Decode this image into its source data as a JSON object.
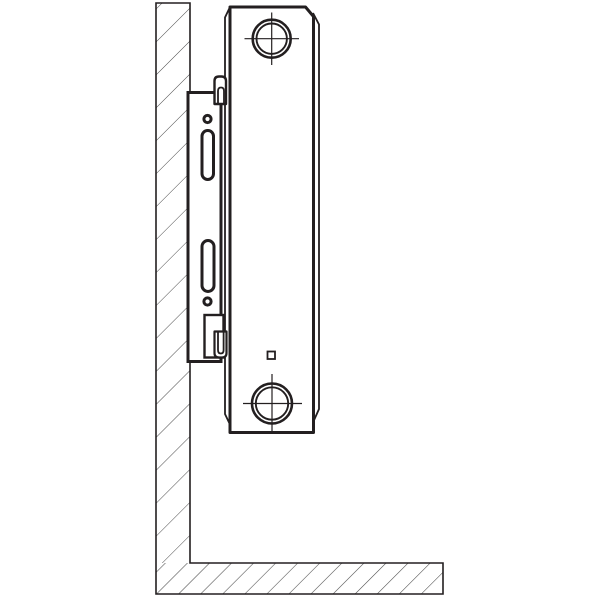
{
  "meta": {
    "kind": "technical-diagram",
    "subject": "radiator-wall-mounting-bracket-side-section"
  },
  "colors": {
    "line": "#231f20",
    "hatch": "#4a4a4a",
    "background": "#ffffff",
    "fill": "#ffffff"
  },
  "canvas": {
    "width": 600,
    "height": 600
  },
  "diagram": {
    "shapes": [
      {
        "name": "wall-section-hatch",
        "type": "rect",
        "attrs": {
          "x": 156,
          "y": 3,
          "width": 34,
          "height": 560,
          "fill": "url(#hatch-wall)",
          "stroke": "none"
        }
      },
      {
        "name": "floor-section-hatch",
        "type": "rect",
        "attrs": {
          "x": 156,
          "y": 563,
          "width": 287,
          "height": 31,
          "fill": "url(#hatch-floor)",
          "stroke": "none"
        }
      },
      {
        "name": "wall-floor-outline",
        "type": "path",
        "attrs": {
          "d": "M 156,3 L 190,3 L 190,563 L 443,563 L 443,594 L 156,594 Z",
          "fill": "none",
          "stroke": "#231f20",
          "stroke-width": 1.6
        }
      },
      {
        "name": "radiator-back-edge-left",
        "type": "path",
        "attrs": {
          "d": "M 229.5,8 L 225,17.5 L 225,414 L 229.5,423.5",
          "fill": "none",
          "stroke": "#231f20",
          "stroke-width": 1.8
        }
      },
      {
        "name": "radiator-back-edge-right",
        "type": "path",
        "attrs": {
          "d": "M 313,13 L 319,24.5 L 319,409 L 313,422.5",
          "fill": "none",
          "stroke": "#231f20",
          "stroke-width": 1.8
        }
      },
      {
        "name": "radiator-body",
        "type": "path",
        "attrs": {
          "d": "M 230,432.5 L 230,7 L 305.5,7 L 313.5,16.5 L 313.5,432.5 Z",
          "fill": "#ffffff",
          "stroke": "#231f20",
          "stroke-width": 3,
          "stroke-linejoin": "round"
        }
      },
      {
        "name": "top-connection-outer-circle",
        "type": "circle",
        "attrs": {
          "cx": 271.7,
          "cy": 38.7,
          "r": 19,
          "fill": "none",
          "stroke": "#231f20",
          "stroke-width": 2.6
        }
      },
      {
        "name": "top-connection-inner-circle",
        "type": "circle",
        "attrs": {
          "cx": 271.7,
          "cy": 38.7,
          "r": 15.2,
          "fill": "none",
          "stroke": "#231f20",
          "stroke-width": 1.9
        }
      },
      {
        "name": "top-connection-crosshair-horizontal",
        "type": "line",
        "attrs": {
          "x1": 244.5,
          "y1": 38.7,
          "x2": 299,
          "y2": 38.7,
          "stroke": "#231f20",
          "stroke-width": 1.2
        }
      },
      {
        "name": "top-connection-crosshair-vertical",
        "type": "line",
        "attrs": {
          "x1": 271.7,
          "y1": 12.5,
          "x2": 271.7,
          "y2": 65,
          "stroke": "#231f20",
          "stroke-width": 1.2
        }
      },
      {
        "name": "bottom-connection-outer-circle",
        "type": "circle",
        "attrs": {
          "cx": 272,
          "cy": 403.5,
          "r": 20,
          "fill": "none",
          "stroke": "#231f20",
          "stroke-width": 2.6
        }
      },
      {
        "name": "bottom-connection-inner-circle",
        "type": "circle",
        "attrs": {
          "cx": 272,
          "cy": 403.5,
          "r": 16.2,
          "fill": "none",
          "stroke": "#231f20",
          "stroke-width": 1.9
        }
      },
      {
        "name": "bottom-connection-crosshair-horizontal",
        "type": "line",
        "attrs": {
          "x1": 243,
          "y1": 403.5,
          "x2": 302,
          "y2": 403.5,
          "stroke": "#231f20",
          "stroke-width": 1.2
        }
      },
      {
        "name": "bottom-connection-crosshair-vertical",
        "type": "line",
        "attrs": {
          "x1": 272,
          "y1": 374,
          "x2": 272,
          "y2": 433.5,
          "stroke": "#231f20",
          "stroke-width": 1.2
        }
      },
      {
        "name": "drain-plug-square",
        "type": "rect",
        "attrs": {
          "x": 267.5,
          "y": 351.5,
          "width": 7.5,
          "height": 7.5,
          "fill": "#ffffff",
          "stroke": "#231f20",
          "stroke-width": 1.8
        }
      },
      {
        "name": "bracket-plate",
        "type": "rect",
        "attrs": {
          "x": 188,
          "y": 92.5,
          "width": 33,
          "height": 269,
          "fill": "#ffffff",
          "stroke": "#231f20",
          "stroke-width": 3
        }
      },
      {
        "name": "bracket-top-clip-outer",
        "type": "path",
        "attrs": {
          "d": "M 214.5,104 L 214.5,81 Q 214.5,76.5 219,76.5 L 221.5,76.5 Q 226,76.5 226,81 L 226,104 Z",
          "fill": "#ffffff",
          "stroke": "#231f20",
          "stroke-width": 2.4,
          "stroke-linejoin": "round"
        }
      },
      {
        "name": "bracket-top-clip-inner",
        "type": "path",
        "attrs": {
          "d": "M 218,104 L 218,91 Q 218,87.5 221,87.5 Q 224,87.5 224,91 L 224,104",
          "fill": "none",
          "stroke": "#231f20",
          "stroke-width": 1.8
        }
      },
      {
        "name": "bracket-bottom-clip-frame",
        "type": "rect",
        "attrs": {
          "x": 204.5,
          "y": 315,
          "width": 19,
          "height": 42.5,
          "fill": "#ffffff",
          "stroke": "#231f20",
          "stroke-width": 2.4
        }
      },
      {
        "name": "bracket-bottom-clip-outer",
        "type": "path",
        "attrs": {
          "d": "M 214.5,331.5 L 214.5,353 Q 214.5,357.5 219,357.5 L 222,357.5 Q 226.5,357.5 226.5,353 L 226.5,331.5 Z",
          "fill": "#ffffff",
          "stroke": "#231f20",
          "stroke-width": 2.2,
          "stroke-linejoin": "round"
        }
      },
      {
        "name": "bracket-bottom-clip-inner",
        "type": "path",
        "attrs": {
          "d": "M 218,331.5 L 218,350 Q 218,353.5 220.8,353.5 Q 223.6,353.5 223.6,350 L 223.6,331.5",
          "fill": "none",
          "stroke": "#231f20",
          "stroke-width": 1.8
        }
      },
      {
        "name": "bracket-screw-hole-top",
        "type": "circle",
        "attrs": {
          "cx": 207.5,
          "cy": 119,
          "r": 3.6,
          "fill": "#ffffff",
          "stroke": "#231f20",
          "stroke-width": 3
        }
      },
      {
        "name": "bracket-slot-top",
        "type": "rect",
        "attrs": {
          "x": 202,
          "y": 130.5,
          "width": 11.5,
          "height": 49,
          "rx": 5.7,
          "fill": "#ffffff",
          "stroke": "#231f20",
          "stroke-width": 3
        }
      },
      {
        "name": "bracket-slot-bottom",
        "type": "rect",
        "attrs": {
          "x": 202,
          "y": 240.5,
          "width": 12,
          "height": 51,
          "rx": 6,
          "fill": "#ffffff",
          "stroke": "#231f20",
          "stroke-width": 3
        }
      },
      {
        "name": "bracket-screw-hole-bottom",
        "type": "circle",
        "attrs": {
          "cx": 207.5,
          "cy": 301.5,
          "r": 3.6,
          "fill": "#ffffff",
          "stroke": "#231f20",
          "stroke-width": 3
        }
      }
    ]
  }
}
